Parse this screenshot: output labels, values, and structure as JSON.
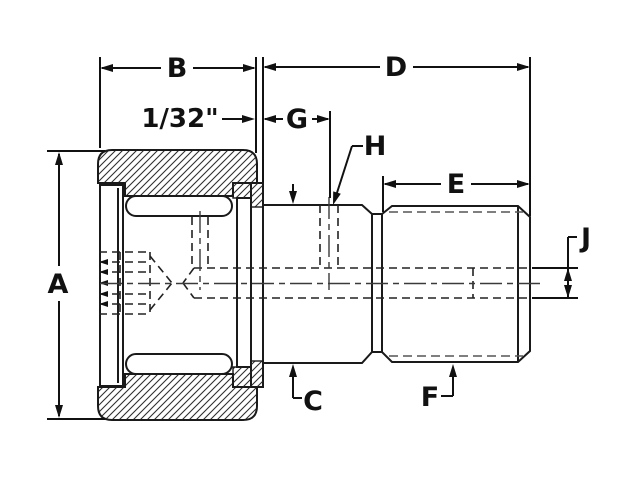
{
  "drawing": {
    "background": "#ffffff",
    "line_color": "#1a1a1a",
    "labels": {
      "a": "A",
      "b": "B",
      "c": "C",
      "d": "D",
      "e": "E",
      "f": "F",
      "g": "G",
      "h": "H",
      "j": "J",
      "gap": "1/32\""
    }
  }
}
